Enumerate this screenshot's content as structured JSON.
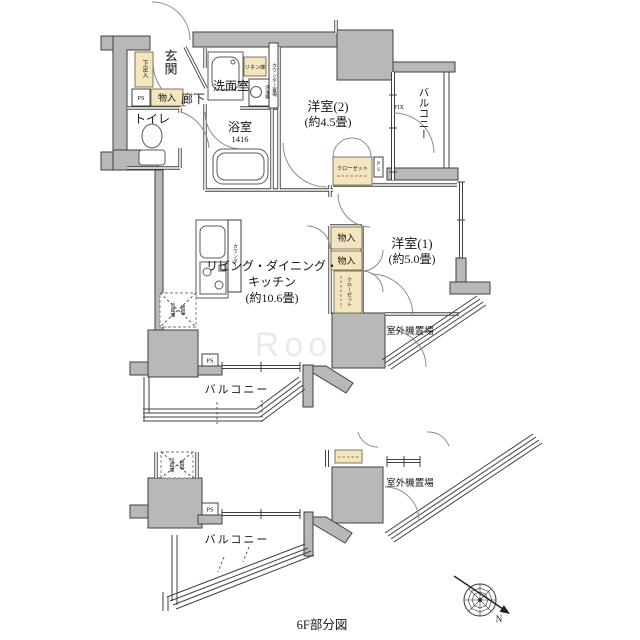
{
  "caption": "6F部分図",
  "watermark": "RooM",
  "compass": {
    "north_label": "N"
  },
  "main_plan": {
    "rooms": {
      "entrance": "玄関",
      "hallway": "廊下",
      "toilet": "トイレ",
      "washroom": "洗面室",
      "bathroom": "浴室",
      "bathroom_size": "1416",
      "bedroom2_name": "洋室(2)",
      "bedroom2_size": "(約4.5畳)",
      "bedroom1_name": "洋室(1)",
      "bedroom1_size": "(約5.0畳)",
      "ldk_line1": "リビング・ダイニング・",
      "ldk_line2": "キッチン",
      "ldk_line3": "(約10.6畳)",
      "balcony_right": "バルコニー",
      "balcony_bottom": "バルコニー",
      "outdoor_unit": "室外機置場"
    },
    "storage": {
      "shoe_box": "下足入",
      "entrance_closet": "物入",
      "linen": "リネン庫",
      "bedroom2_closet": "クローゼット",
      "storage1": "物入",
      "storage2": "物入",
      "bedroom1_closet": "クローゼット"
    },
    "labels": {
      "ps1": "PS",
      "ps2": "PS",
      "ps3": "PS",
      "fix_window": "FIX",
      "counter_washroom": "カウンター",
      "counter_kitchen": "カウンター",
      "washer_line1": "洗濯機",
      "washer_line2": "置場",
      "fridge_line1": "冷蔵庫",
      "fridge_line2": "置場"
    }
  },
  "sub_plan": {
    "balcony": "バルコニー",
    "outdoor_unit": "室外機置場",
    "ps": "PS",
    "fridge_line1": "冷蔵庫",
    "fridge_line2": "置場"
  }
}
